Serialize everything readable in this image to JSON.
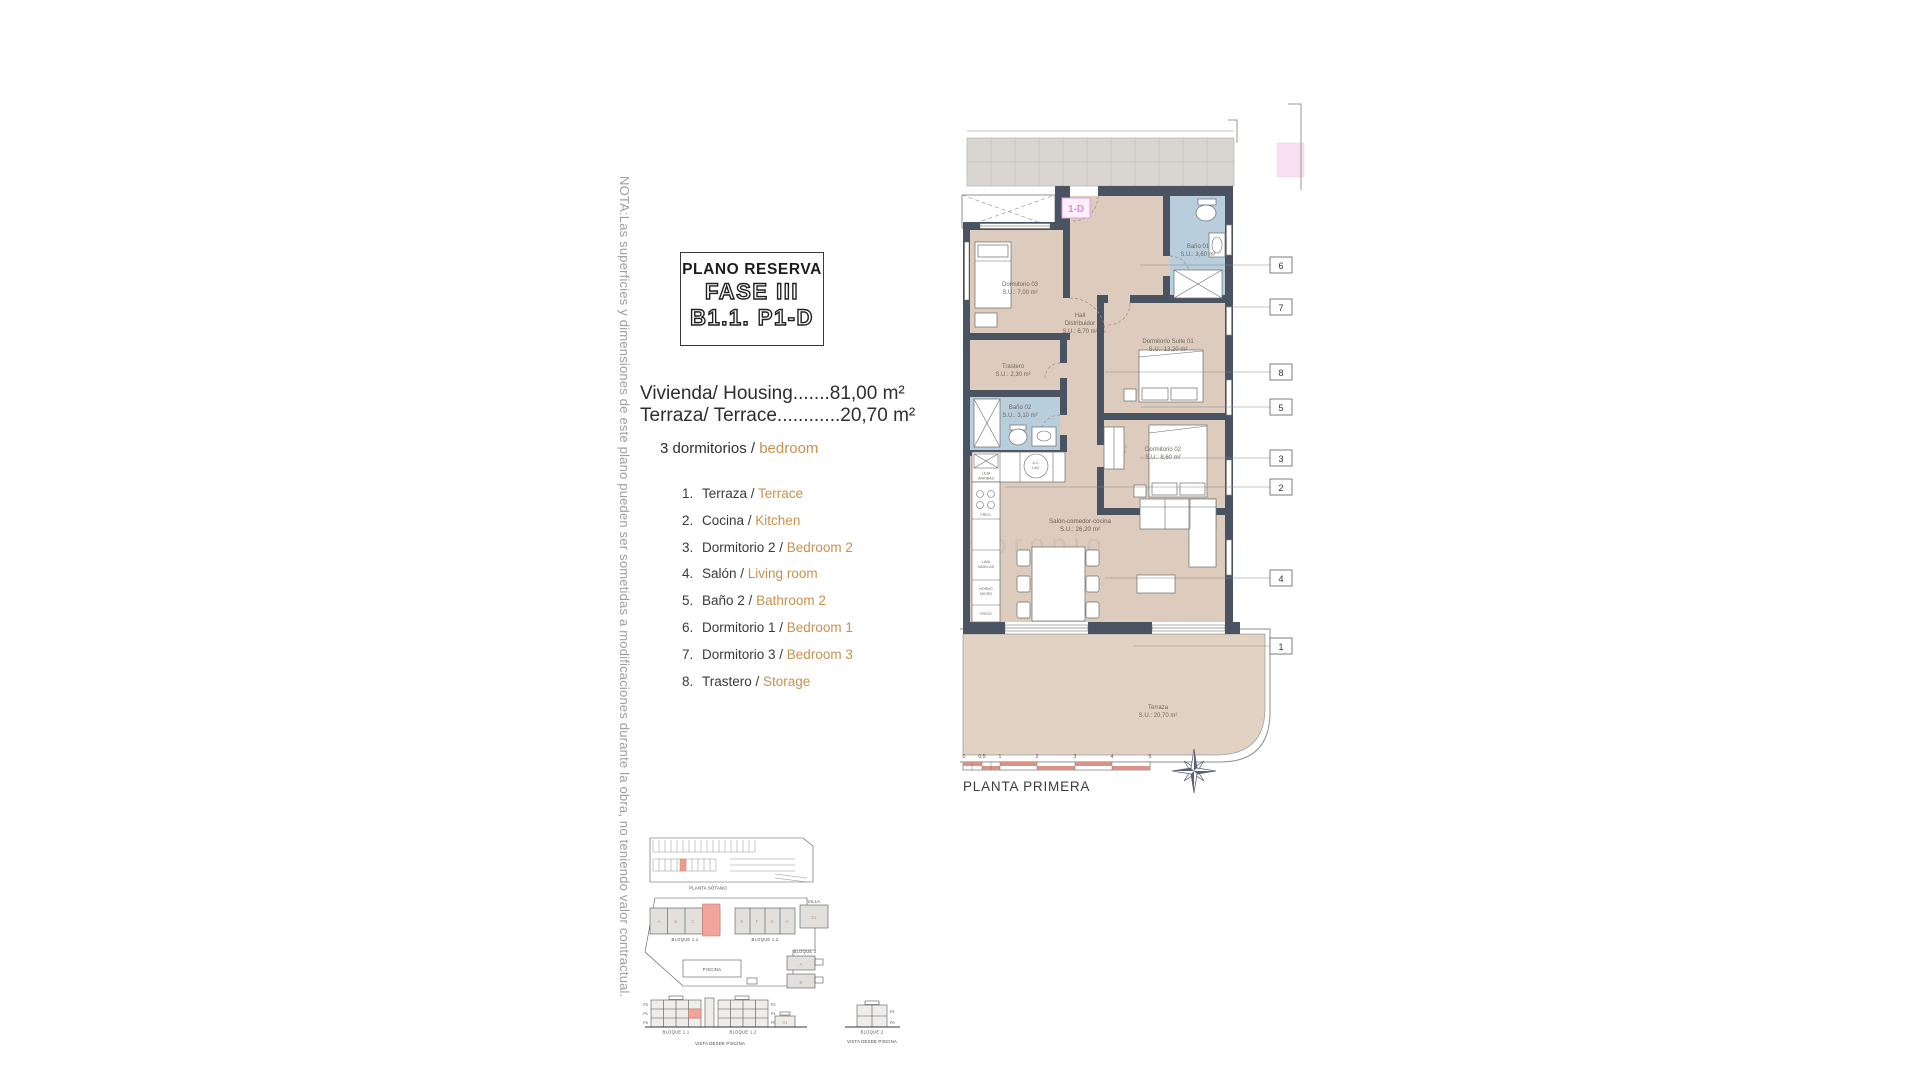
{
  "note": "NOTA:Las superficies y dimensiones de este plano pueden ser sometidas a modificaciones durante la obra, no teniendo valor contractual.",
  "title": {
    "line1": "PLANO RESERVA",
    "line2": "FASE III",
    "line3": "B1.1. P1-D"
  },
  "summary": {
    "housing": "Vivienda/ Housing.......81,00 m²",
    "terrace": "Terraza/ Terrace............20,70 m²",
    "bedrooms_es": "3 dormitorios /",
    "bedrooms_en": "bedroom"
  },
  "legend": {
    "items": [
      {
        "num": "1.",
        "es": "Terraza /",
        "en": "Terrace"
      },
      {
        "num": "2.",
        "es": "Cocina /",
        "en": "Kitchen"
      },
      {
        "num": "3.",
        "es": "Dormitorio 2 /",
        "en": "Bedroom 2"
      },
      {
        "num": "4.",
        "es": "Salón /",
        "en": "Living room"
      },
      {
        "num": "5.",
        "es": "Baño 2 /",
        "en": "Bathroom 2"
      },
      {
        "num": "6.",
        "es": "Dormitorio 1 /",
        "en": "Bedroom 1"
      },
      {
        "num": "7.",
        "es": "Dormitorio 3 /",
        "en": "Bedroom 3"
      },
      {
        "num": "8.",
        "es": "Trastero /",
        "en": "Storage"
      }
    ]
  },
  "plan": {
    "unit_badge": "1-D",
    "watermark": "propio",
    "rooms": {
      "dorm03": {
        "name": "Dormitorio 03",
        "area": "S.U.: 7,00 m²"
      },
      "bano01": {
        "name": "Baño 01",
        "area": "S.U.: 3,60 m²"
      },
      "hall": {
        "name": "Hall",
        "name2": "Distribuidor",
        "area": "S.U.: 6,70 m²"
      },
      "suite": {
        "name": "Dormitorio Suite 01",
        "area": "S.U.: 13,20 m²"
      },
      "trastero": {
        "name": "Trastero",
        "area": "S.U.: 2,30 m²"
      },
      "bano02": {
        "name": "Baño 02",
        "area": "S.U.: 3,10 m²"
      },
      "dorm02": {
        "name": "Dormitorio 02",
        "area": "S.U.: 8,60 m²"
      },
      "salon": {
        "name": "Salón-comedor-cocina",
        "area": "S.U.: 26,20 m²"
      },
      "terraza": {
        "name": "Terraza",
        "area": "S.U.: 20,70 m²"
      }
    },
    "kitchen": {
      "freg": "FREG.",
      "lava1": "LAVA",
      "lava2": "VAJILLAS",
      "horno1": "HORNO",
      "horno2": "MICRO",
      "frigo": "FRIGO",
      "ac1": "A.C.",
      "ac2": "LAV.",
      "leja1": "LEJA",
      "leja2": "ARRIBAS"
    },
    "callouts": [
      "1",
      "2",
      "3",
      "4",
      "5",
      "6",
      "7",
      "8"
    ],
    "scale_ticks": [
      "0",
      "0.5",
      "1",
      "2",
      "3",
      "4",
      "5"
    ],
    "caption": "PLANTA PRIMERA"
  },
  "site": {
    "basement_caption": "PLANTA SÓTANO",
    "b11": "BLOQUE 1.1",
    "b12": "BLOQUE 1.2",
    "b2": "BLOQUE 2",
    "villa": "VILLA",
    "villa_num": "01",
    "piscina": "PISCINA",
    "view_caption": "VISTA DESDE PISCINA",
    "b11_letters": [
      "A",
      "B",
      "C"
    ],
    "b12_letters": [
      "E",
      "F",
      "G",
      "H"
    ],
    "b2_letters": [
      "A",
      "B"
    ],
    "floors": [
      "P2",
      "P1",
      "P0"
    ],
    "floors_b2": [
      "P1",
      "P0"
    ]
  }
}
